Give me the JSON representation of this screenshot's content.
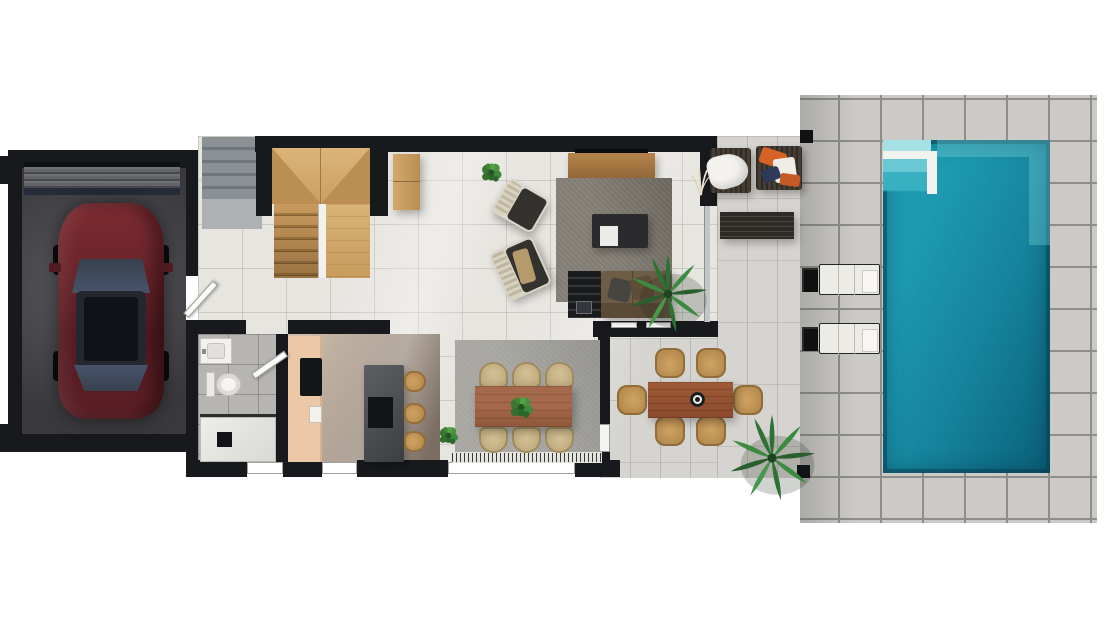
{
  "image": {
    "type": "3d-floor-plan-rendering",
    "view": "top-down",
    "visible_text": "none"
  },
  "palette": {
    "background": "#ffffff",
    "wall": "#17191c",
    "interior_floor": "#e7e5e0",
    "terrace_floor": "#d6d4d0",
    "deck_paver": "#cbcac6",
    "pool_water": "#1b95ac",
    "pool_deep": "#0c647e",
    "pool_steps_light": "#a5e0e4",
    "garage_floor": "#46464a",
    "car_body": "#6b2329",
    "stair_wood": "#cfa468",
    "rug_living": "#827d74",
    "rug_dining": "#a7a6a1",
    "sofa_brown": "#6e5d46",
    "dining_table_wood": "#a4684a",
    "outdoor_table_wood": "#9c5535",
    "kitchen_cabinet": "#ecc8a7",
    "kitchen_island": "#4a4c50",
    "chair_beige": "#c9b286",
    "stool_tan": "#c59c5e",
    "lounger_white": "#edebe6",
    "plant_green": "#2f7034",
    "pillow_orange": "#d76226",
    "pillow_navy": "#2d3a5a"
  },
  "scene": {
    "garage": {
      "objects": [
        "garage-door",
        "parked-car"
      ]
    },
    "entry": {
      "objects": [
        "entry-steps",
        "entry-door"
      ]
    },
    "staircase": {
      "material": "wood",
      "flights": 2,
      "objects": [
        "landing",
        "left-flight-treads",
        "glass-divider",
        "right-flight",
        "hall-console"
      ]
    },
    "living_room": {
      "objects": [
        "wall-tv",
        "tv-console",
        "area-rug",
        "coffee-table",
        "white-tray",
        "armchair-1",
        "armchair-2",
        "sofa",
        "media-shelf",
        "throw-pillow-gray",
        "throw-pillow-brown",
        "potted-bush",
        "palm-plant",
        "pampas-grass"
      ]
    },
    "dining_area": {
      "objects": [
        "fringed-rug",
        "dining-table",
        "dining-chairs",
        "table-centerpiece-plant",
        "floor-plant"
      ],
      "chair_count": 6
    },
    "kitchen": {
      "objects": [
        "wall-cabinets",
        "cooktop",
        "sink",
        "island",
        "bar-stools"
      ],
      "stool_count": 3
    },
    "bathroom": {
      "objects": [
        "vanity-sink",
        "toilet",
        "walk-in-shower",
        "shower-drain",
        "bathroom-door"
      ]
    },
    "terrace": {
      "objects": [
        "outdoor-sofa-left",
        "outdoor-sofa-right",
        "white-throw",
        "orange-pillow",
        "navy-pillow",
        "slatted-coffee-table",
        "pergola-post-top",
        "pergola-post-bottom",
        "palm-plant"
      ]
    },
    "outdoor_dining": {
      "objects": [
        "outdoor-table",
        "centerpiece-bowl",
        "outdoor-chairs"
      ],
      "chair_count": 6
    },
    "pool_area": {
      "objects": [
        "paver-deck",
        "swimming-pool",
        "corner-steps",
        "step-divider-wall",
        "sun-lounger-1",
        "sun-lounger-2",
        "lounger-side-tables"
      ],
      "lounger_count": 2
    }
  }
}
